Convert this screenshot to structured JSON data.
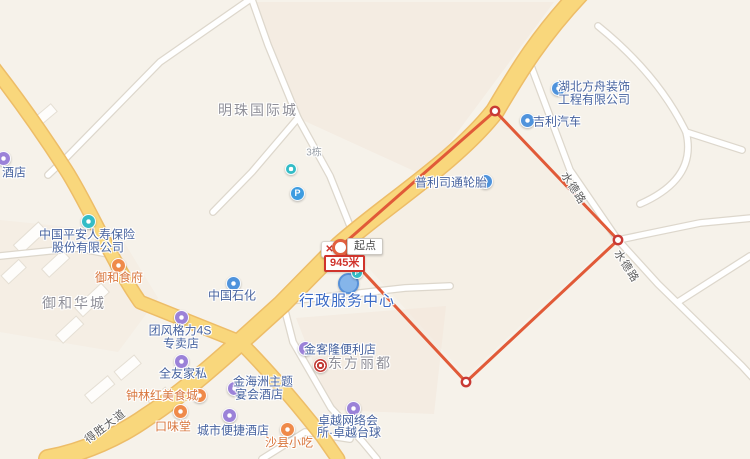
{
  "app": {
    "name": "map-distance-measurement-view"
  },
  "measurement": {
    "start_label": "起点",
    "distance_label": "945米",
    "close_glyph": "✕"
  },
  "glyphs": {
    "parking": "P"
  },
  "pois": [
    {
      "label": "酒店"
    },
    {
      "line1": "湖北方舟装饰",
      "line2": "工程有限公司"
    },
    {
      "label": "吉利汽车"
    },
    {
      "label": "普利司通轮胎"
    },
    {
      "line1": "中国平安人寿保险",
      "line2": "股份有限公司"
    },
    {
      "label": "御和食府"
    },
    {
      "label": "中国石化"
    },
    {
      "label": "行政服务中心"
    },
    {
      "line1": "团风格力4S",
      "line2": "专卖店"
    },
    {
      "label": "全友家私"
    },
    {
      "line1": "金海洲主题",
      "line2": "宴会酒店"
    },
    {
      "label": "钟林红美食城"
    },
    {
      "label": "口味堂"
    },
    {
      "label": "城市便捷酒店"
    },
    {
      "label": "沙县小吃"
    },
    {
      "label": "金客隆便利店"
    },
    {
      "line1": "卓越网络会",
      "line2": "所·卓越台球"
    }
  ],
  "areas": [
    {
      "label": "明珠国际城"
    },
    {
      "label": "御和华城"
    },
    {
      "label": "东方丽都"
    },
    {
      "label": "3栋"
    }
  ],
  "road_labels": [
    {
      "label": "得胜大道"
    },
    {
      "label": "水德路"
    },
    {
      "label": "水德路"
    }
  ],
  "colors": {
    "background": "#f6f2ea",
    "road_major": "#f9d77c",
    "road_major_casing": "#edbd68",
    "road_minor": "#ffffff",
    "measure_line": "#e15a38",
    "vertex_ring": "#c93a34",
    "poi_text": "#47639f",
    "poi_food_text": "#d8753c",
    "area_text": "#8f8f98",
    "highlight_text": "#3a6ac5"
  }
}
